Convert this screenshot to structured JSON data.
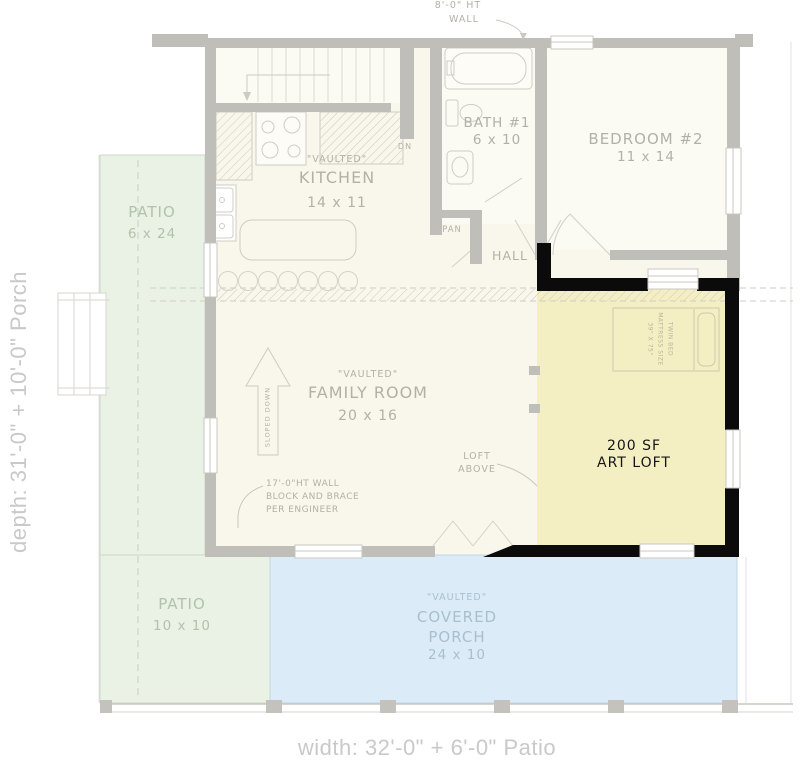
{
  "dimension_labels": {
    "depth": "depth: 31'-0\" + 10'-0\" Porch",
    "width": "width: 32'-0\" + 6'-0\" Patio"
  },
  "rooms": {
    "kitchen": {
      "note": "\"VAULTED\"",
      "name": "KITCHEN",
      "size": "14 x 11"
    },
    "bath1": {
      "name": "BATH #1",
      "size": "6 x 10"
    },
    "bedroom2": {
      "name": "BEDROOM #2",
      "size": "11 x 14"
    },
    "hall": {
      "name": "HALL"
    },
    "pantry": {
      "name": "PAN"
    },
    "family_room": {
      "note": "\"VAULTED\"",
      "name": "FAMILY ROOM",
      "size": "20 x 16"
    },
    "art_loft": {
      "area": "200 SF",
      "name": "ART LOFT"
    },
    "patio_side": {
      "name": "PATIO",
      "size": "6 x 24"
    },
    "patio_rear": {
      "name": "PATIO",
      "size": "10 x 10"
    },
    "covered_porch": {
      "note": "\"VAULTED\"",
      "name": "COVERED PORCH",
      "size": "24 x 10"
    }
  },
  "annotations": {
    "wall_height_line1": "8'-0\" HT",
    "wall_height_line2": "WALL",
    "stairs_down": "DN",
    "sloped_down": "SLOPED DOWN",
    "loft_above_line1": "LOFT",
    "loft_above_line2": "ABOVE",
    "engineer_line1": "17'-0\"HT WALL",
    "engineer_line2": "BLOCK AND BRACE",
    "engineer_line3": "PER ENGINEER",
    "bed_line1": "TWIN BED",
    "bed_line2": "MATTRESS SIZE",
    "bed_line3": "39\" X 75\""
  },
  "colors": {
    "interior": "#F9F7EB",
    "art_loft_highlight": "#F4EFC3",
    "patio": "#E9F2E4",
    "covered_porch": "#DBECF8",
    "wall": "#C0BEB9",
    "accent_wall": "#0B0B0B",
    "label_text": "#B2B0A8",
    "dimension_text": "#C9C9C9"
  }
}
